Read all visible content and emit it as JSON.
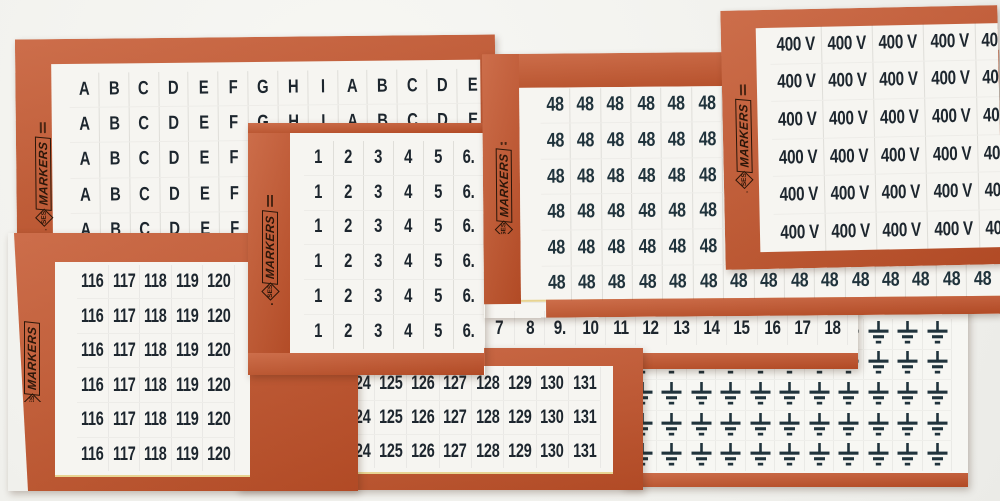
{
  "brand": {
    "ses": "SES",
    "markers": "MARKERS"
  },
  "colors": {
    "card_orange": "#c2522a",
    "label_white": "#f6f5f1",
    "ink": "#1d262e",
    "ink_teal": "#20333c",
    "background": "#f3f3f0",
    "edge_highlight": "#e8d492"
  },
  "cards": [
    {
      "id": "letters",
      "row_labels": [
        "A",
        "B",
        "C",
        "D",
        "E",
        "F",
        "G",
        "H",
        "I",
        "A",
        "B",
        "C",
        "D",
        "E"
      ],
      "row_count": 5,
      "has_logo": true
    },
    {
      "id": "ground",
      "symbol": "earth-ground-icon",
      "columns": 11,
      "rows": 5
    },
    {
      "id": "numbers-7-18",
      "row_labels": [
        "7",
        "8",
        "9.",
        "10",
        "11",
        "12",
        "13",
        "14",
        "15",
        "16",
        "17",
        "18"
      ],
      "row_count": 1
    },
    {
      "id": "numbers-121-131",
      "row_labels": [
        "121",
        "122",
        "123",
        "124",
        "125",
        "126",
        "127",
        "128",
        "129",
        "130",
        "131"
      ],
      "row_count": 3
    },
    {
      "id": "numbers-116-120",
      "row_labels": [
        "116",
        "117",
        "118",
        "119",
        "120"
      ],
      "row_count": 6,
      "has_logo": true
    },
    {
      "id": "numbers-1-6",
      "row_labels": [
        "1",
        "2",
        "3",
        "4",
        "5",
        "6."
      ],
      "row_count": 6,
      "has_logo": true
    },
    {
      "id": "numbers-48",
      "label": "48",
      "columns": 15,
      "rows": 6,
      "has_logo": true
    },
    {
      "id": "voltage-400",
      "label": "400 V",
      "columns": 5,
      "rows": 6,
      "has_logo": true
    }
  ]
}
